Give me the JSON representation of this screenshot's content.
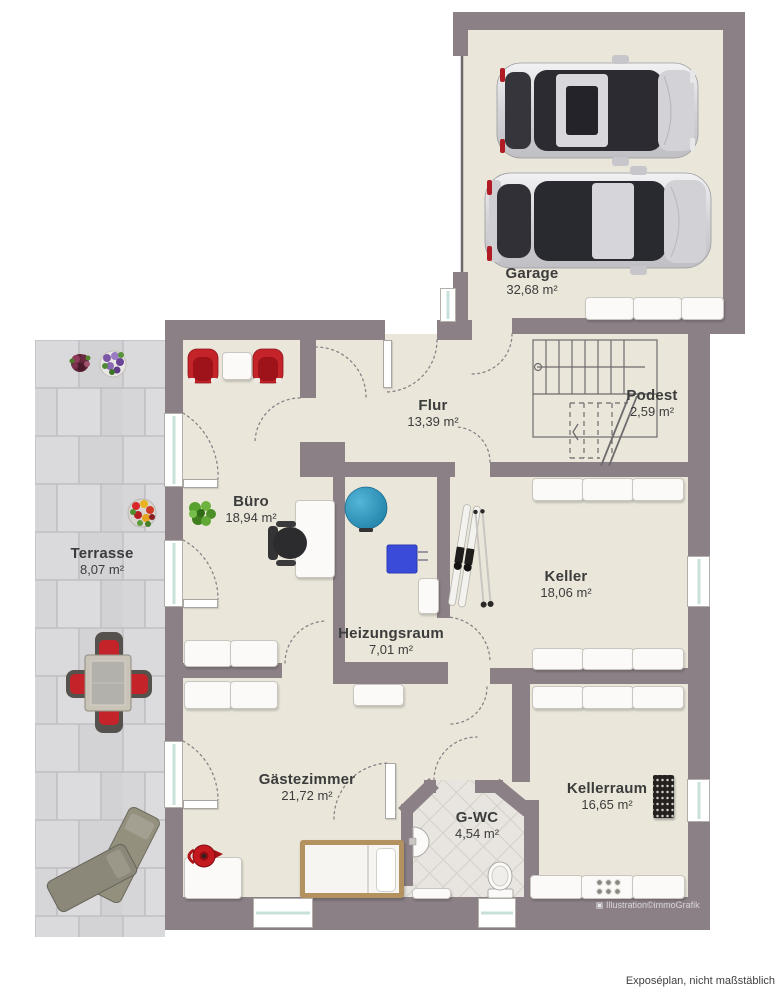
{
  "footer": {
    "note": "Exposéplan, nicht maßstäblich"
  },
  "watermark": {
    "text": "Illustration©immoGrafik"
  },
  "rooms": {
    "garage": {
      "label": "Garage",
      "area": "32,68 m²"
    },
    "flur": {
      "label": "Flur",
      "area": "13,39 m²"
    },
    "podest": {
      "label": "Podest",
      "area": "2,59 m²"
    },
    "buero": {
      "label": "Büro",
      "area": "18,94 m²"
    },
    "terrasse": {
      "label": "Terrasse",
      "area": "8,07 m²"
    },
    "keller": {
      "label": "Keller",
      "area": "18,06 m²"
    },
    "heizungsraum": {
      "label": "Heizungsraum",
      "area": "7,01 m²"
    },
    "gaestezimmer": {
      "label": "Gästezimmer",
      "area": "21,72 m²"
    },
    "gwc": {
      "label": "G-WC",
      "area": "4,54 m²"
    },
    "kellerraum": {
      "label": "Kellerraum",
      "area": "16,65 m²"
    }
  },
  "colors": {
    "wall": "#8b8086",
    "floor": "#eae7da",
    "terrace": "#d8d7d9",
    "glass": "#c8e0da",
    "accent-red": "#c4232a",
    "tank-blue": "#2d93ba",
    "boiler-blue": "#3a4ad9",
    "plant-green": "#55a02e",
    "bed-frame": "#b4925f",
    "label-text": "#3c3c3c"
  }
}
